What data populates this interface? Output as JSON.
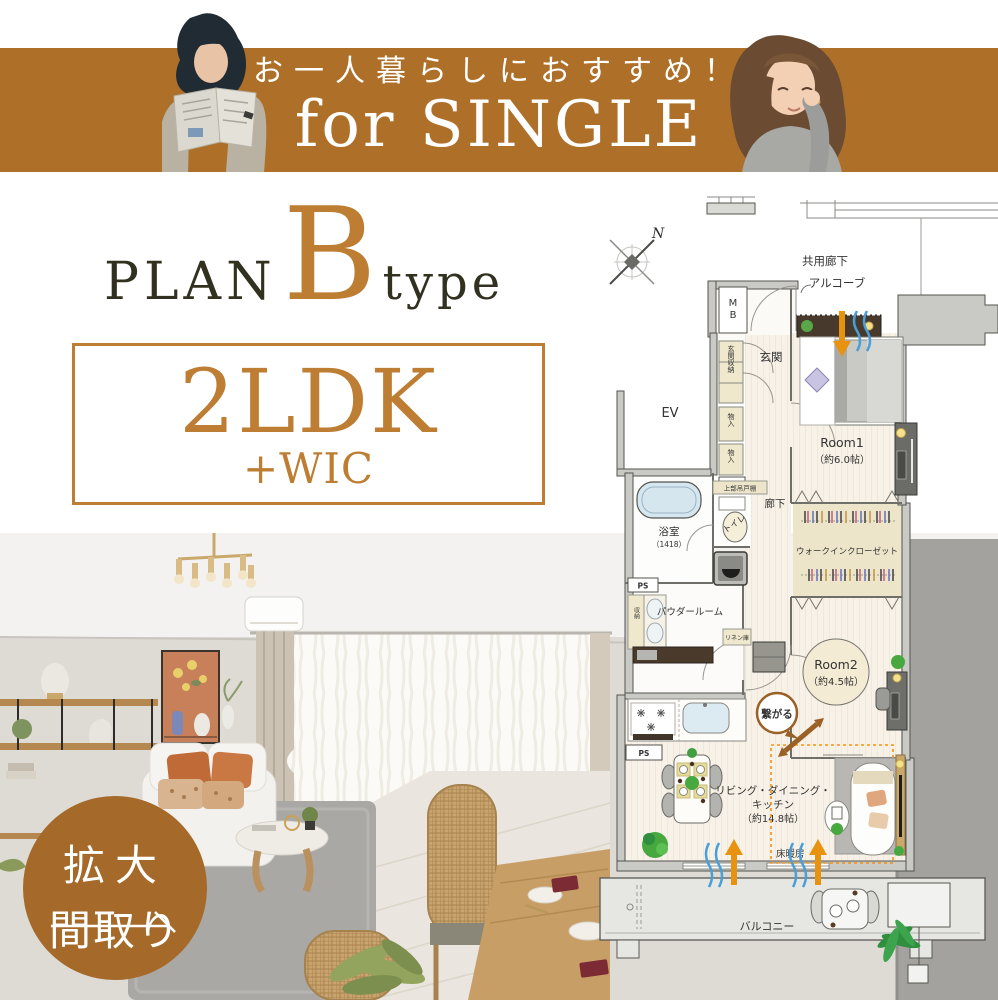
{
  "banner": {
    "tagline": "お一人暮らしにおすすめ！",
    "title": "for SINGLE"
  },
  "plan_title": {
    "plan": "PLAN",
    "letter": "B",
    "type": "type"
  },
  "layout_box": {
    "main": "2LDK",
    "sub": "+WIC"
  },
  "zoom_badge": {
    "line1": "拡大",
    "line2": "間取り"
  },
  "colors": {
    "banner_brown": "#ae7029",
    "accent_orange": "#bd7d33",
    "badge_brown": "#a5692a",
    "floor_heating_orange": "#f29212",
    "connect_brown": "#9a6026"
  },
  "floorplan": {
    "compass_n": "N",
    "common_corridor": "共用廊下",
    "alcove": "アルコーブ",
    "mb_line1": "M",
    "mb_line2": "B",
    "entrance": "玄関",
    "entrance_storage": "玄関収納",
    "elevator": "EV",
    "closet1": "物入",
    "closet2": "物入",
    "ps1": "PS",
    "ps2": "PS",
    "ps3": "PS",
    "upper_cabinet": "上部吊戸棚",
    "bathroom": "浴室",
    "bathroom_size": "（1418）",
    "toilet": "トイレ",
    "corridor": "廊下",
    "powder_room": "パウダールーム",
    "storage": "収納",
    "linen": "リネン庫",
    "wic": "ウォークインクローゼット",
    "room1": "Room1",
    "room1_size": "（約6.0帖）",
    "room2": "Room2",
    "room2_size": "（約4.5帖）",
    "ldk_line1": "リビング・ダイニング・",
    "ldk_line2": "キッチン",
    "ldk_line3": "（約14.8帖）",
    "floor_heating": "床暖房",
    "connect": "繋がる",
    "balcony": "バルコニー"
  }
}
